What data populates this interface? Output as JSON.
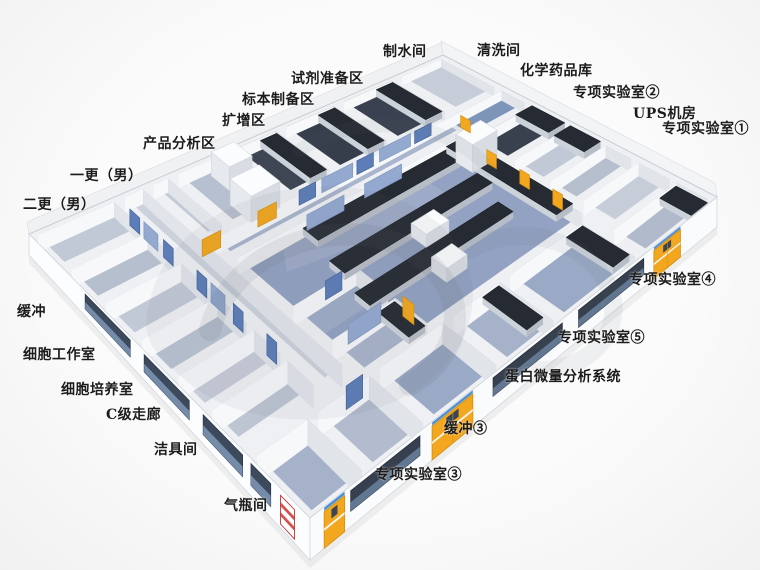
{
  "colors": {
    "door_yellow": "#f2a71f",
    "door_blue": "#5d7db8",
    "glass_blue": "#93a9cf",
    "floor_blue": "#93a2c2",
    "bench_dark": "#262b33",
    "wall_white": "#eef0f3",
    "sign_blue": "#4a90d8",
    "sign_red": "#cc3333",
    "label_color": "#1c1c1c"
  },
  "labels": {
    "water_room": "制水间",
    "cleaning_room": "清洗间",
    "chemical_store": "化学药品库",
    "special_lab_2": "专项实验室②",
    "ups_room": "UPS机房",
    "special_lab_1": "专项实验室①",
    "reagent_prep": "试剂准备区",
    "specimen_prep": "标本制备区",
    "amplification": "扩增区",
    "product_analysis": "产品分析区",
    "change_room_1": "一更（男）",
    "change_room_2": "二更（男）",
    "buffer": "缓冲",
    "cell_workroom": "细胞工作室",
    "cell_culture": "细胞培养室",
    "c_grade_corridor": "C级走廊",
    "cleaning_tools": "洁具间",
    "gas_cylinder": "气瓶间",
    "special_lab_4": "专项实验室④",
    "special_lab_5": "专项实验室⑤",
    "protein_system": "蛋白微量分析系统",
    "buffer_3": "缓冲③",
    "special_lab_3": "专项实验室③"
  }
}
